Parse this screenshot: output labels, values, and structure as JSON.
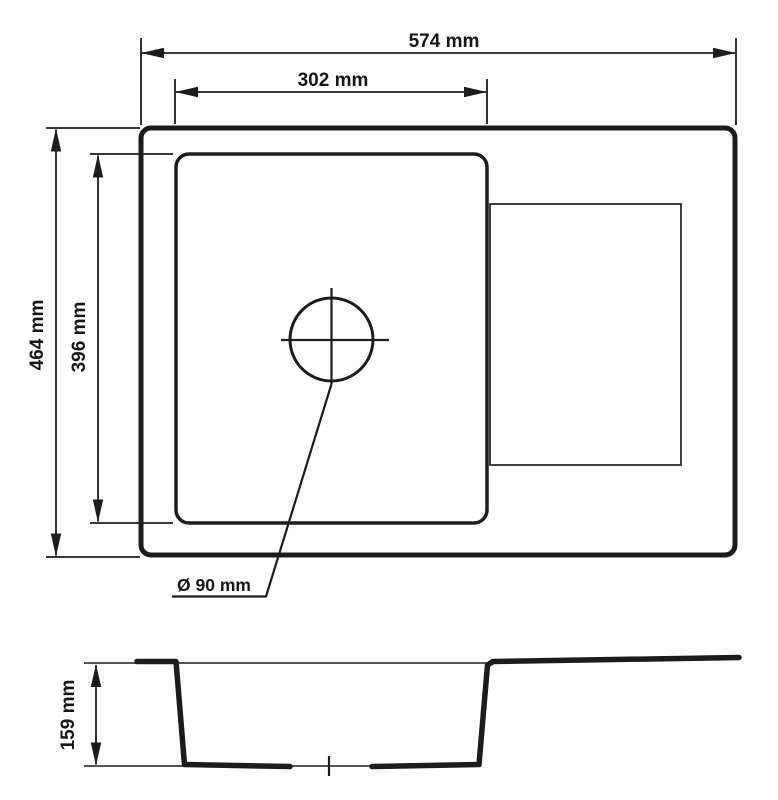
{
  "drawing": {
    "type": "technical-dimension-diagram",
    "labels": {
      "overall_width": "574 mm",
      "bowl_width": "302 mm",
      "overall_depth": "464 mm",
      "bowl_depth": "396 mm",
      "drain_diameter": "Ø 90 mm",
      "bowl_height": "159 mm"
    },
    "dimensions_mm": {
      "overall_width": 574,
      "bowl_inner_width": 302,
      "overall_depth": 464,
      "bowl_inner_depth": 396,
      "drain_diameter": 90,
      "bowl_section_depth": 159
    },
    "colors": {
      "line": "#1c1c1c",
      "background": "#ffffff"
    }
  }
}
